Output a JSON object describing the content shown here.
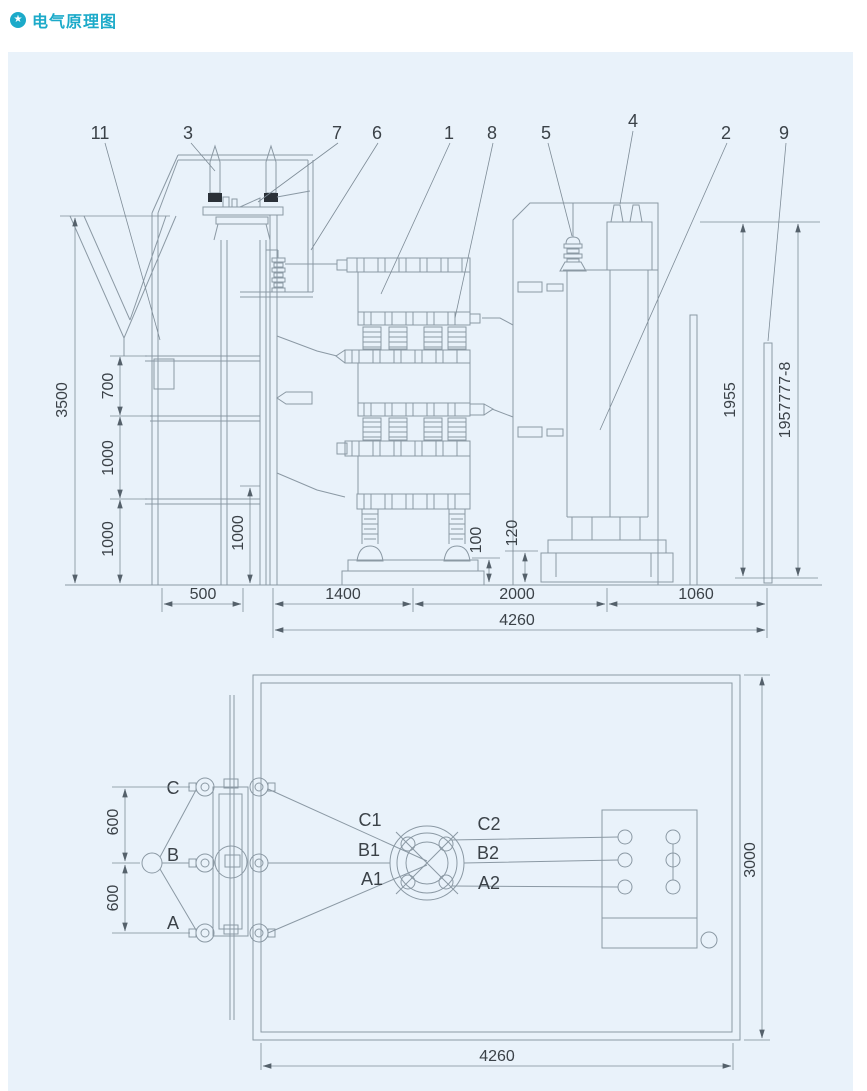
{
  "header": {
    "title": "电气原理图",
    "icon_glyph": "★"
  },
  "colors": {
    "accent": "#1caac9",
    "panel_bg": "#e9f2fa",
    "line": "#8b99a4",
    "text": "#3b4248"
  },
  "elevation": {
    "callouts": [
      "11",
      "3",
      "7",
      "6",
      "1",
      "8",
      "5",
      "4",
      "2",
      "9"
    ],
    "dims": {
      "total_height": "3500",
      "level_top": "700",
      "level_mid": "1000",
      "level_bottom": "1000",
      "pit_depth": "1000",
      "base_height_left": "100",
      "base_height_right": "120",
      "right_height": "1955",
      "right_code": "1957777-8",
      "span_left": "500",
      "span_reactor": "1400",
      "span_mid": "2000",
      "span_right": "1060",
      "span_total": "4260"
    }
  },
  "plan": {
    "phases": {
      "c": "C",
      "b": "B",
      "a": "A",
      "c1": "C1",
      "b1": "B1",
      "a1": "A1",
      "c2": "C2",
      "b2": "B2",
      "a2": "A2"
    },
    "dims": {
      "phase_spacing_top": "600",
      "phase_spacing_bottom": "600",
      "depth": "3000",
      "width": "4260"
    }
  }
}
